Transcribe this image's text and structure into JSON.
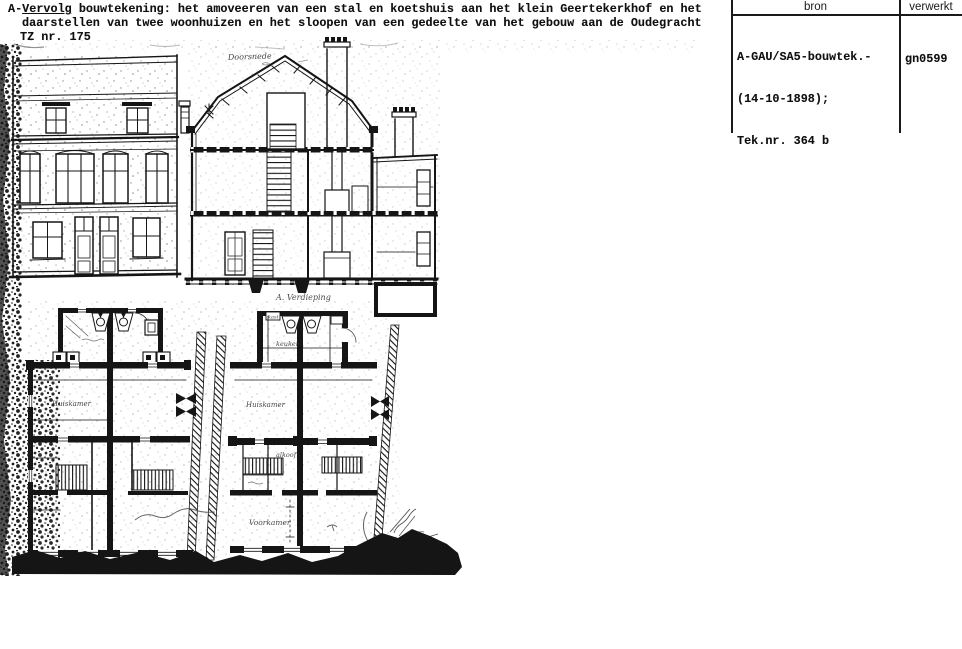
{
  "document": {
    "description": {
      "line1_prefix": "A-",
      "line1_underlined": "Vervolg",
      "line1_rest": " bouwtekening: het amoveeren van een stal en koetshuis aan het klein Geertekerkhof en het",
      "line2": "daarstellen van twee woonhuizen en het sloopen van een gedeelte van het gebouw aan de Oudegracht",
      "line3": "TZ nr. 175"
    },
    "record_table": {
      "col_bron_label": "bron",
      "col_verwerkt_label": "verwerkt",
      "bron_line1": "A-GAU/SA5-bouwtek.-",
      "bron_line2": "(14-10-1898);",
      "bron_line3": "Tek.nr. 364 b",
      "verwerkt_value": "gn0599"
    },
    "drawing_labels": {
      "section": "Doorsnede",
      "floor_plan": "A. Verdieping",
      "room_huiskamer_left": "Huiskamer",
      "room_huiskamer_right": "Huiskamer",
      "room_keuken": "keuken",
      "room_kast": "kast",
      "room_alkoof": "alkoof",
      "room_voorkamer": "Voorkamer"
    },
    "colors": {
      "ink": "#151515",
      "paper": "#ffffff"
    }
  }
}
